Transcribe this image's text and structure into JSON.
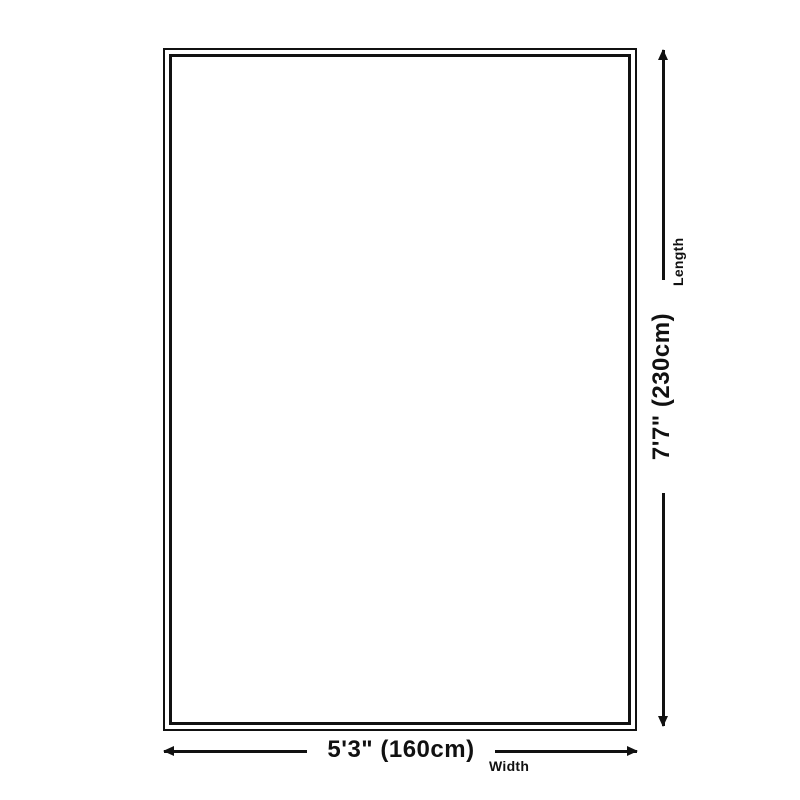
{
  "diagram": {
    "line_color": "#111111",
    "background_color": "#ffffff",
    "width_dimension": {
      "value": "5'3\" (160cm)",
      "label": "Width"
    },
    "length_dimension": {
      "value": "7'7\" (230cm)",
      "label": "Length"
    }
  }
}
